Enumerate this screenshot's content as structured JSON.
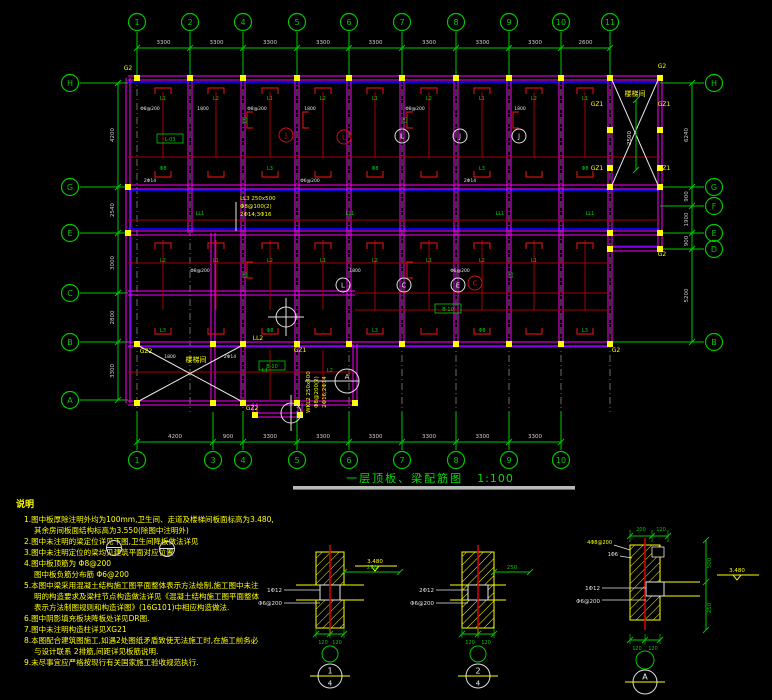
{
  "title": {
    "text": "一层顶板、梁配筋图",
    "scale": "1:100"
  },
  "colors": {
    "axis_green": "#00c800",
    "beam_magenta": "#ff00ff",
    "beam_red": "#aa0000",
    "slab_blue": "#0000dd",
    "note_yellow": "#ffff00",
    "dim_gray": "#cfcfcf"
  },
  "axes": {
    "top": [
      [
        "1",
        137
      ],
      [
        "2",
        190
      ],
      [
        "4",
        243
      ],
      [
        "5",
        297
      ],
      [
        "6",
        349
      ],
      [
        "7",
        402
      ],
      [
        "8",
        456
      ],
      [
        "9",
        509
      ],
      [
        "10",
        561
      ],
      [
        "11",
        610
      ]
    ],
    "bottom": [
      [
        "1",
        137
      ],
      [
        "3",
        213
      ],
      [
        "4",
        243
      ],
      [
        "5",
        297
      ],
      [
        "6",
        349
      ],
      [
        "7",
        402
      ],
      [
        "8",
        456
      ],
      [
        "9",
        509
      ],
      [
        "10",
        561
      ]
    ],
    "left": [
      [
        "H",
        83
      ],
      [
        "G",
        187
      ],
      [
        "E",
        233
      ],
      [
        "C",
        293
      ],
      [
        "B",
        342
      ],
      [
        "A",
        400
      ]
    ],
    "right": [
      [
        "H",
        83
      ],
      [
        "G",
        187
      ],
      [
        "F",
        206
      ],
      [
        "E",
        233
      ],
      [
        "D",
        249
      ],
      [
        "B",
        342
      ]
    ],
    "dims_top": [
      "3300",
      "3300",
      "3300",
      "3300",
      "3300",
      "3300",
      "3300",
      "3300",
      "2600"
    ],
    "dims_bottom": [
      "4200",
      "900",
      "3300",
      "3300",
      "3300",
      "3300",
      "3300",
      "3300"
    ],
    "dims_left": [
      "4200",
      "2540",
      "3000",
      "2800",
      "3300"
    ],
    "dims_right": [
      "6240",
      "900",
      "1900",
      "900",
      "5200"
    ]
  },
  "plan_labels": {
    "stair_room": "楼梯间",
    "stair_dim": "2500",
    "beam_stack": [
      "LL3 250x500",
      "Φ8@100(2)",
      "2Φ14;3Φ16"
    ],
    "beam_stack2": [
      "WKL2 250x400",
      "Φ8@200(2)",
      "2Φ16;2Φ14"
    ],
    "yellow": [
      [
        "G2",
        128,
        70
      ],
      [
        "G2",
        662,
        68
      ],
      [
        "GZ1",
        597,
        106
      ],
      [
        "GZ1",
        664,
        106
      ],
      [
        "GZ1",
        597,
        170
      ],
      [
        "GZ1",
        664,
        170
      ],
      [
        "G2",
        616,
        352
      ],
      [
        "GZ2",
        146,
        353
      ],
      [
        "LL2",
        258,
        340
      ],
      [
        "GZ1",
        300,
        352
      ],
      [
        "GZ2",
        252,
        410
      ],
      [
        "G2",
        662,
        256
      ]
    ],
    "green": [
      [
        "L1",
        163,
        100
      ],
      [
        "L2",
        216,
        100
      ],
      [
        "L1",
        270,
        100
      ],
      [
        "L2",
        323,
        100
      ],
      [
        "L1",
        375,
        100
      ],
      [
        "L2",
        429,
        100
      ],
      [
        "L1",
        482,
        100
      ],
      [
        "L2",
        534,
        100
      ],
      [
        "L1",
        585,
        100
      ],
      [
        "Φ8",
        163,
        170
      ],
      [
        "L3",
        270,
        170
      ],
      [
        "Φ8",
        375,
        170
      ],
      [
        "L3",
        482,
        170
      ],
      [
        "Φ8",
        585,
        170
      ],
      [
        "LL1",
        200,
        215
      ],
      [
        "LL1",
        350,
        215
      ],
      [
        "LL1",
        500,
        215
      ],
      [
        "LL1",
        590,
        215
      ],
      [
        "L2",
        163,
        262
      ],
      [
        "L1",
        216,
        262
      ],
      [
        "L2",
        270,
        262
      ],
      [
        "L1",
        323,
        262
      ],
      [
        "L2",
        375,
        262
      ],
      [
        "L1",
        429,
        262
      ],
      [
        "L2",
        482,
        262
      ],
      [
        "L1",
        534,
        262
      ],
      [
        "L3",
        163,
        332
      ],
      [
        "Φ8",
        270,
        332
      ],
      [
        "L3",
        375,
        332
      ],
      [
        "Φ8",
        482,
        332
      ],
      [
        "L3",
        585,
        332
      ],
      [
        "L1",
        265,
        372
      ],
      [
        "L2",
        330,
        372
      ]
    ],
    "green_rot": [
      [
        "L5",
        247,
        120
      ],
      [
        "L5",
        407,
        120
      ],
      [
        "L5",
        247,
        275
      ],
      [
        "L5",
        513,
        275
      ]
    ],
    "green_boxed": [
      [
        "L-03",
        170,
        140
      ],
      [
        "B-10",
        272,
        367
      ],
      [
        "B-10",
        448,
        310
      ]
    ],
    "white": [
      [
        "Φ8@200",
        150,
        110
      ],
      [
        "1800",
        203,
        110
      ],
      [
        "Φ8@200",
        257,
        110
      ],
      [
        "1800",
        310,
        110
      ],
      [
        "Φ8@200",
        415,
        110
      ],
      [
        "1800",
        520,
        110
      ],
      [
        "2Φ14",
        150,
        182
      ],
      [
        "Φ6@200",
        310,
        182
      ],
      [
        "2Φ14",
        470,
        182
      ],
      [
        "Φ8@200",
        200,
        272
      ],
      [
        "1800",
        355,
        272
      ],
      [
        "Φ8@200",
        460,
        272
      ],
      [
        "1800",
        170,
        358
      ],
      [
        "2Φ14",
        230,
        358
      ]
    ],
    "red_circled": [
      [
        "J",
        286,
        135
      ],
      [
        "L",
        344,
        137
      ],
      [
        "C",
        475,
        283
      ]
    ],
    "white_circled": [
      [
        "L",
        402,
        136
      ],
      [
        "J",
        460,
        136
      ],
      [
        "J",
        519,
        136
      ],
      [
        "L",
        343,
        285
      ],
      [
        "C",
        404,
        285
      ],
      [
        "E",
        458,
        285
      ]
    ],
    "cut_circle_right_id": "A"
  },
  "notes": {
    "title": "说明",
    "lines": [
      [
        0,
        "1.图中板厚除注明外均为100mm,卫生间、走道及楼梯间板面标高为3.480,"
      ],
      [
        1,
        "其余房间板面结构标高为3.550(除图中注明外)"
      ],
      [
        0,
        "2.图中未注明的梁定位详见下图,卫生间降板做法详见"
      ],
      [
        0,
        "3.图中未注明定位的梁均见建筑平面对应位置"
      ],
      [
        0,
        "4.图中板顶筋为   Φ8@200"
      ],
      [
        1,
        "图中板负筋分布筋   Φ6@200"
      ],
      [
        0,
        "5.本图中梁采用混凝土结构施工图平面整体表示方法绘制,施工图中未注"
      ],
      [
        1,
        "明的构造要求及梁柱节点构造做法详见《混凝土结构施工图平面整体"
      ],
      [
        1,
        "表示方法制图规则和构造详图》(16G101)中相应构造做法."
      ],
      [
        0,
        "6.图中阴影填充板块降板处详见DR图."
      ],
      [
        0,
        "7.图中未注明构造柱详见XG21"
      ],
      [
        0,
        "8.本图配合建筑图施工,如遇2处图纸矛盾致使无法施工时,在施工前务必"
      ],
      [
        1,
        "与设计联系   2排筋,间距详见板筋说明."
      ],
      [
        0,
        "9.未尽事宜应严格按现行有关国家施工验收规范执行."
      ]
    ]
  },
  "details": [
    {
      "id": "1",
      "den": "4",
      "left_labels": [
        "1Φ12",
        "Φ6@200"
      ],
      "right_dim": "250",
      "bottom_dims": [
        "120",
        "120"
      ],
      "level": "3.480"
    },
    {
      "id": "2",
      "den": "4",
      "left_labels": [
        "2Φ12",
        "Φ6@200"
      ],
      "right_dim": "250",
      "bottom_dims": [
        "120",
        "120"
      ],
      "level": ""
    },
    {
      "id": "A",
      "den": "",
      "left_labels": [
        "1Φ12",
        "Φ6@200"
      ],
      "top_dims": [
        "200",
        "120"
      ],
      "right_dims": [
        "500",
        "250"
      ],
      "bottom_dims": [
        "120",
        "120"
      ],
      "level": "3.480",
      "extra": [
        "4Φ8@200",
        "1Φ6"
      ]
    }
  ]
}
